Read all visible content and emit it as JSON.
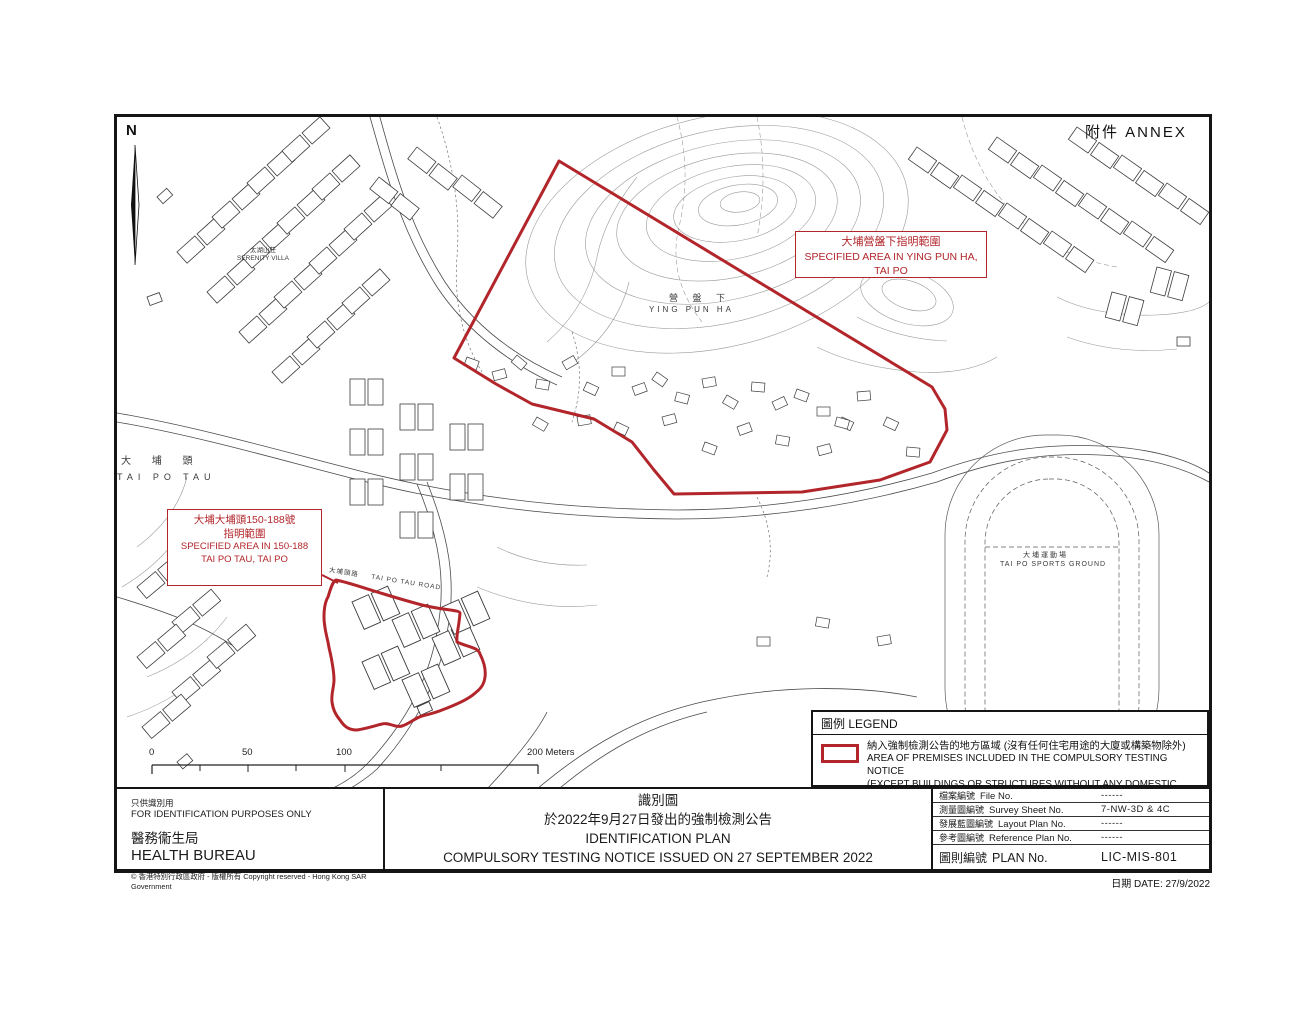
{
  "annex_label": "附件  ANNEX",
  "north_label": "N",
  "map_labels": {
    "tai_po_tau_zh": "大 埔 頭",
    "tai_po_tau_en": "TAI PO TAU",
    "ying_pun_ha_zh": "營 盤 下",
    "ying_pun_ha_en": "YING PUN HA",
    "sports_zh": "大埔運動場",
    "sports_en": "TAI PO SPORTS GROUND",
    "serenity_zh": "太湖山莊",
    "serenity_en": "SERENITY VILLA",
    "road_zh": "大埔頭路",
    "road_en": "TAI PO TAU ROAD"
  },
  "callout_ying_pun_ha": {
    "zh": "大埔營盤下指明範圍",
    "en": "SPECIFIED AREA IN YING PUN HA, TAI PO"
  },
  "callout_tai_po_tau": {
    "zh1": "大埔大埔頭150-188號",
    "zh2": "指明範圍",
    "en1": "SPECIFIED AREA IN 150-188",
    "en2": "TAI PO TAU, TAI PO"
  },
  "scale_bar": {
    "t0": "0",
    "t50": "50",
    "t100": "100",
    "t200": "200 Meters"
  },
  "legend": {
    "title": "圖例 LEGEND",
    "item_zh": "納入強制檢測公告的地方區域 (沒有任何住宅用途的大廈或構築物除外)",
    "item_en1": "AREA OF PREMISES INCLUDED IN THE COMPULSORY TESTING NOTICE",
    "item_en2": "(EXCEPT BUILDINGS OR STRUCTURES WITHOUT ANY DOMESTIC PURPOSES)"
  },
  "title_block": {
    "left": {
      "zh_note": "只供識別用",
      "en_note": "FOR IDENTIFICATION PURPOSES ONLY",
      "zh_org": "醫務衞生局",
      "en_org": "HEALTH BUREAU",
      "copyright": "© 香港特別行政區政府 - 版權所有   Copyright reserved - Hong Kong SAR Government"
    },
    "center": {
      "zh1": "識別圖",
      "zh2": "於2022年9月27日發出的強制檢測公告",
      "en1": "IDENTIFICATION PLAN",
      "en2": "COMPULSORY TESTING NOTICE ISSUED ON 27 SEPTEMBER 2022"
    },
    "right_rows": [
      {
        "zh": "檔案編號",
        "en": "File No.",
        "value": "------"
      },
      {
        "zh": "測量圖編號",
        "en": "Survey Sheet No.",
        "value": "7-NW-3D  &  4C"
      },
      {
        "zh": "發展藍圖編號",
        "en": "Layout Plan No.",
        "value": "------"
      },
      {
        "zh": "參考圖編號",
        "en": "Reference Plan No.",
        "value": "------"
      },
      {
        "zh": "圖則編號",
        "en": "PLAN  No.",
        "value": "LIC-MIS-801"
      }
    ],
    "date": "日期   DATE:  27/9/2022"
  },
  "colors": {
    "boundary_red": "#b2262b",
    "map_line": "#3c3c3c",
    "contour_gray": "#9a9a9a"
  }
}
